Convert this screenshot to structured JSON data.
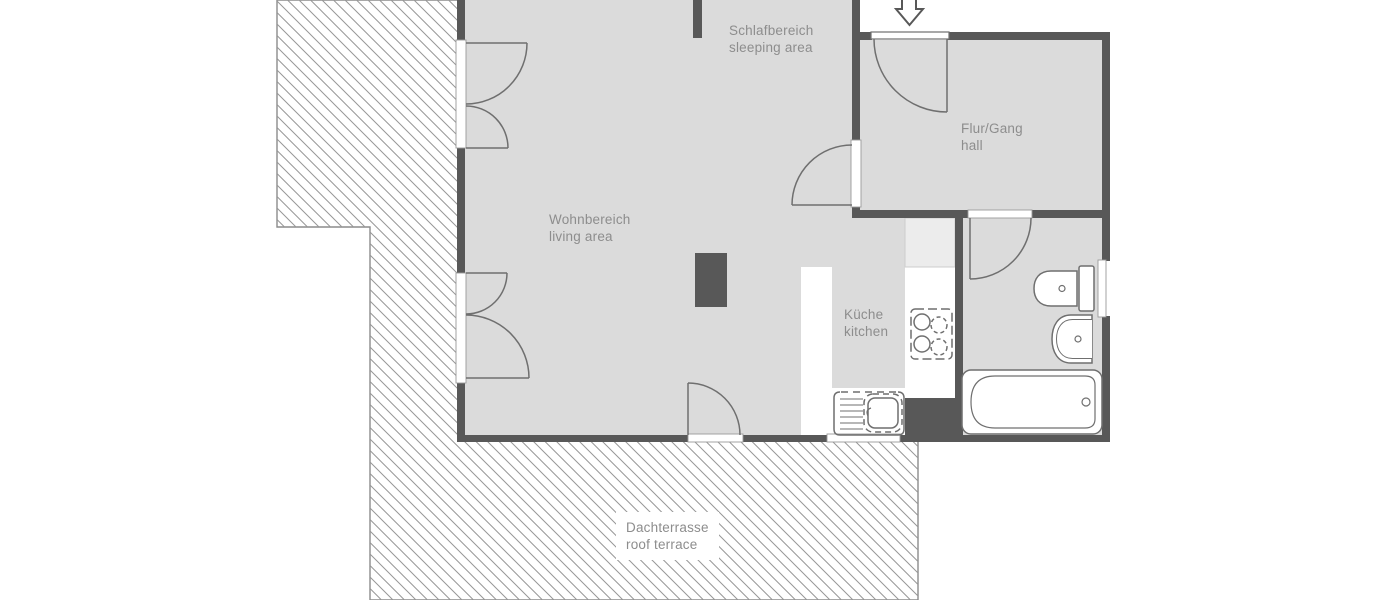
{
  "title": "apartment floor plan",
  "plan": {
    "rooms": {
      "sleeping": {
        "de": "Schlafbereich",
        "en": "sleeping area"
      },
      "living": {
        "de": "Wohnbereich",
        "en": "living area"
      },
      "hall": {
        "de": "Flur/Gang",
        "en": "hall"
      },
      "kitchen": {
        "de": "Küche",
        "en": "kitchen"
      },
      "terrace": {
        "de": "Dachterrasse",
        "en": "roof terrace"
      }
    },
    "fixtures": [
      "entrance-arrow",
      "entrance-door",
      "double-door",
      "interior-door",
      "toilet",
      "washbasin",
      "bathtub",
      "stove",
      "kitchen-sink",
      "kitchen-counter",
      "tall-unit",
      "chimney",
      "window"
    ],
    "colors": {
      "background": "#ffffff",
      "floor": "#dbdbdb",
      "wall": "#585858",
      "outline": "#6f6f6f",
      "label_text": "#8d8d8d",
      "hatch_line": "#979797",
      "terrace_border": "#8c8c8c",
      "tall_unit_fill": "#ececec"
    }
  }
}
